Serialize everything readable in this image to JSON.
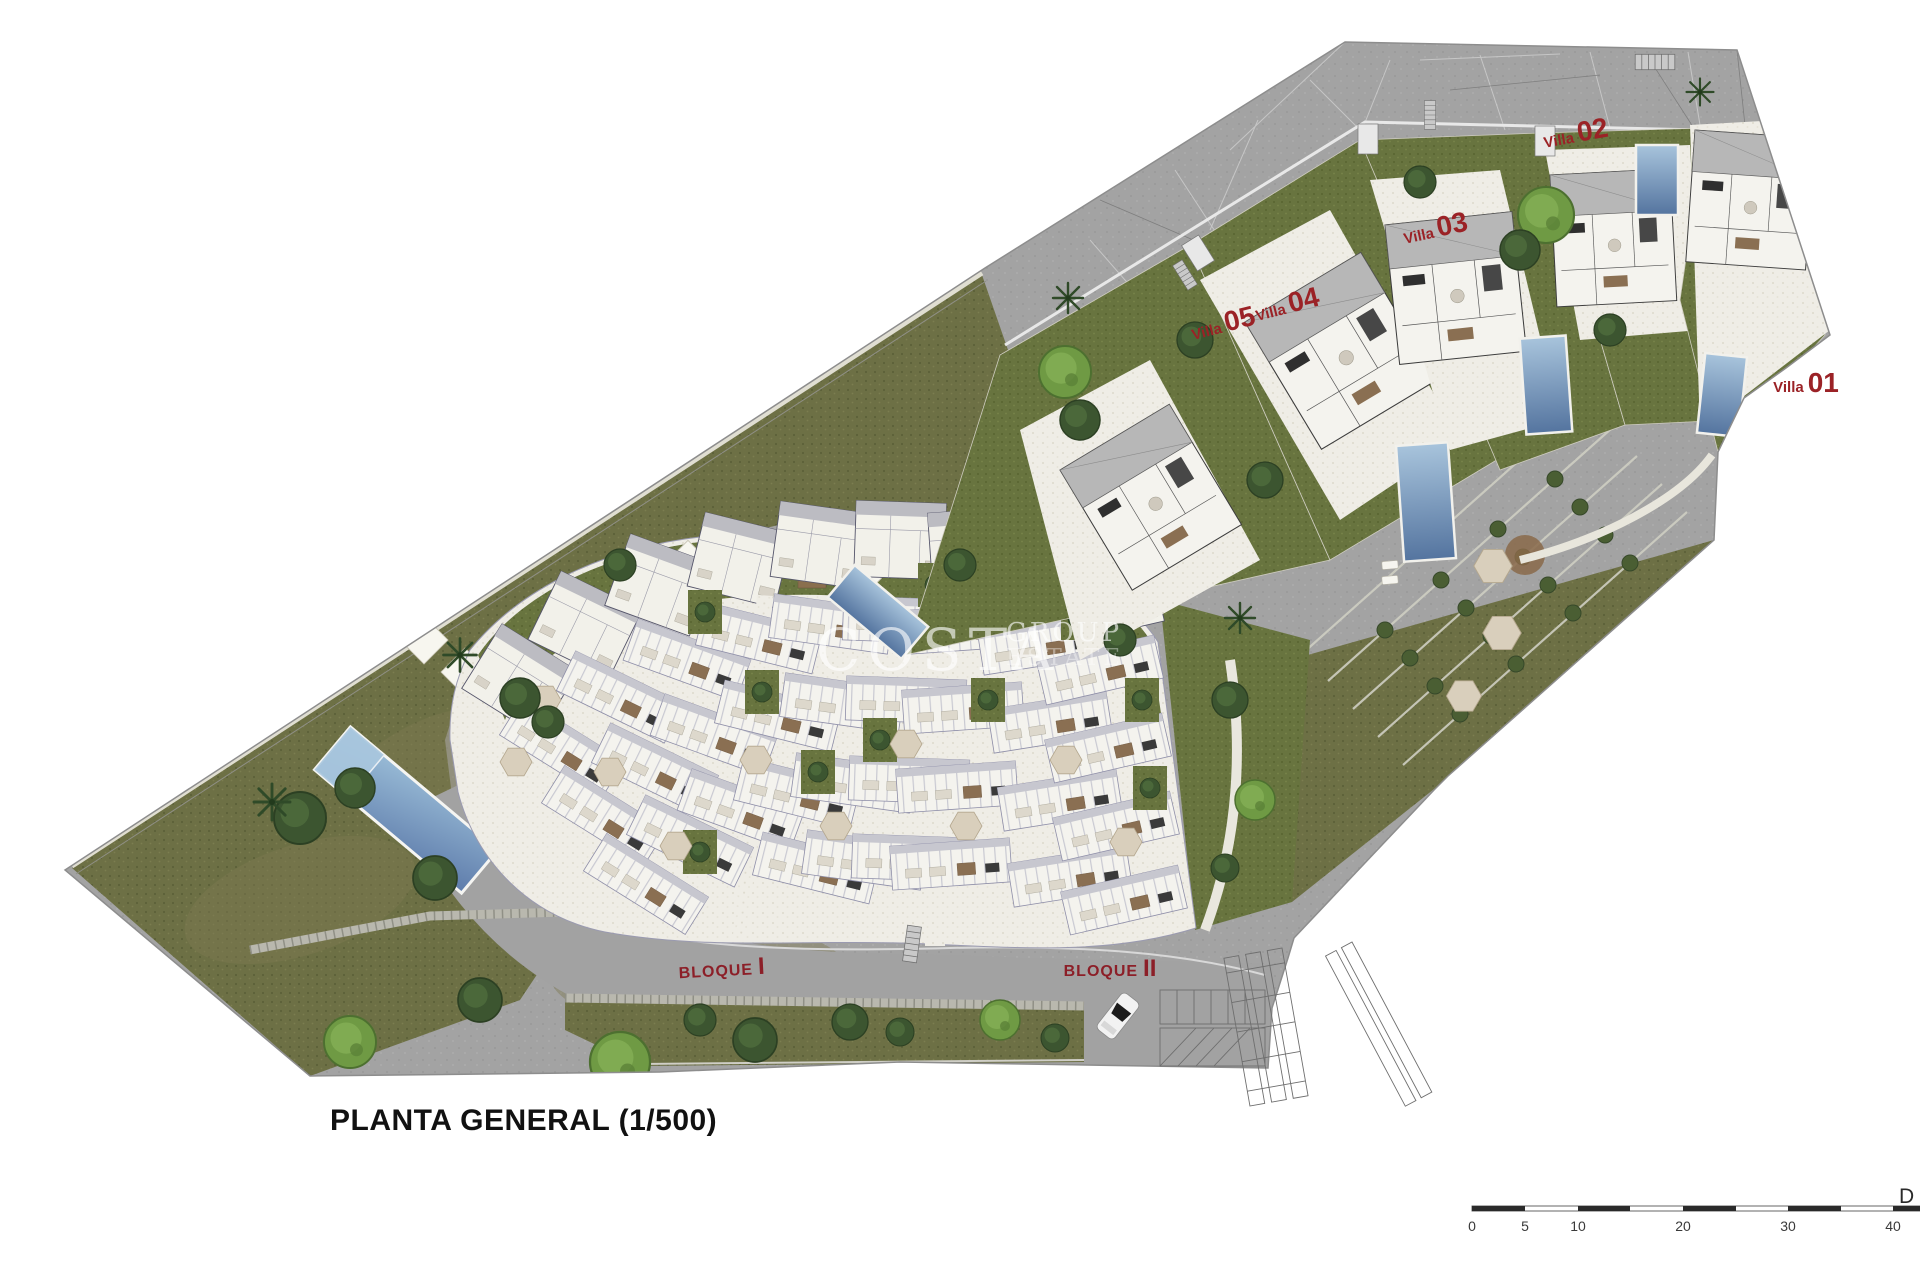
{
  "title": {
    "text": "PLANTA GENERAL (1/500)"
  },
  "watermark": {
    "primary": "COSTA",
    "secondary": "GROUP",
    "tertiary": "ESTATE"
  },
  "villa_labels": [
    {
      "prefix": "Villa",
      "number": "01"
    },
    {
      "prefix": "Villa",
      "number": "02"
    },
    {
      "prefix": "Villa",
      "number": "03"
    },
    {
      "prefix": "Villa",
      "number": "04"
    },
    {
      "prefix": "Villa",
      "number": "05"
    }
  ],
  "block_labels": [
    {
      "word": "BLOQUE",
      "numeral": "I"
    },
    {
      "word": "BLOQUE",
      "numeral": "II"
    }
  ],
  "scale_bar": {
    "tick_labels": [
      "0",
      "5",
      "10",
      "20",
      "30",
      "40"
    ],
    "edge_label": "D"
  },
  "colors": {
    "villa_label": "#9b2226",
    "block_label": "#8c1f28",
    "road": "#a3a3a3",
    "hill_green": "#6d7045",
    "lawn_green": "#68743f",
    "paving": "#efede6",
    "pool_blue": "#6e93bd",
    "title_text": "#111111",
    "watermark": "#ffffff"
  }
}
